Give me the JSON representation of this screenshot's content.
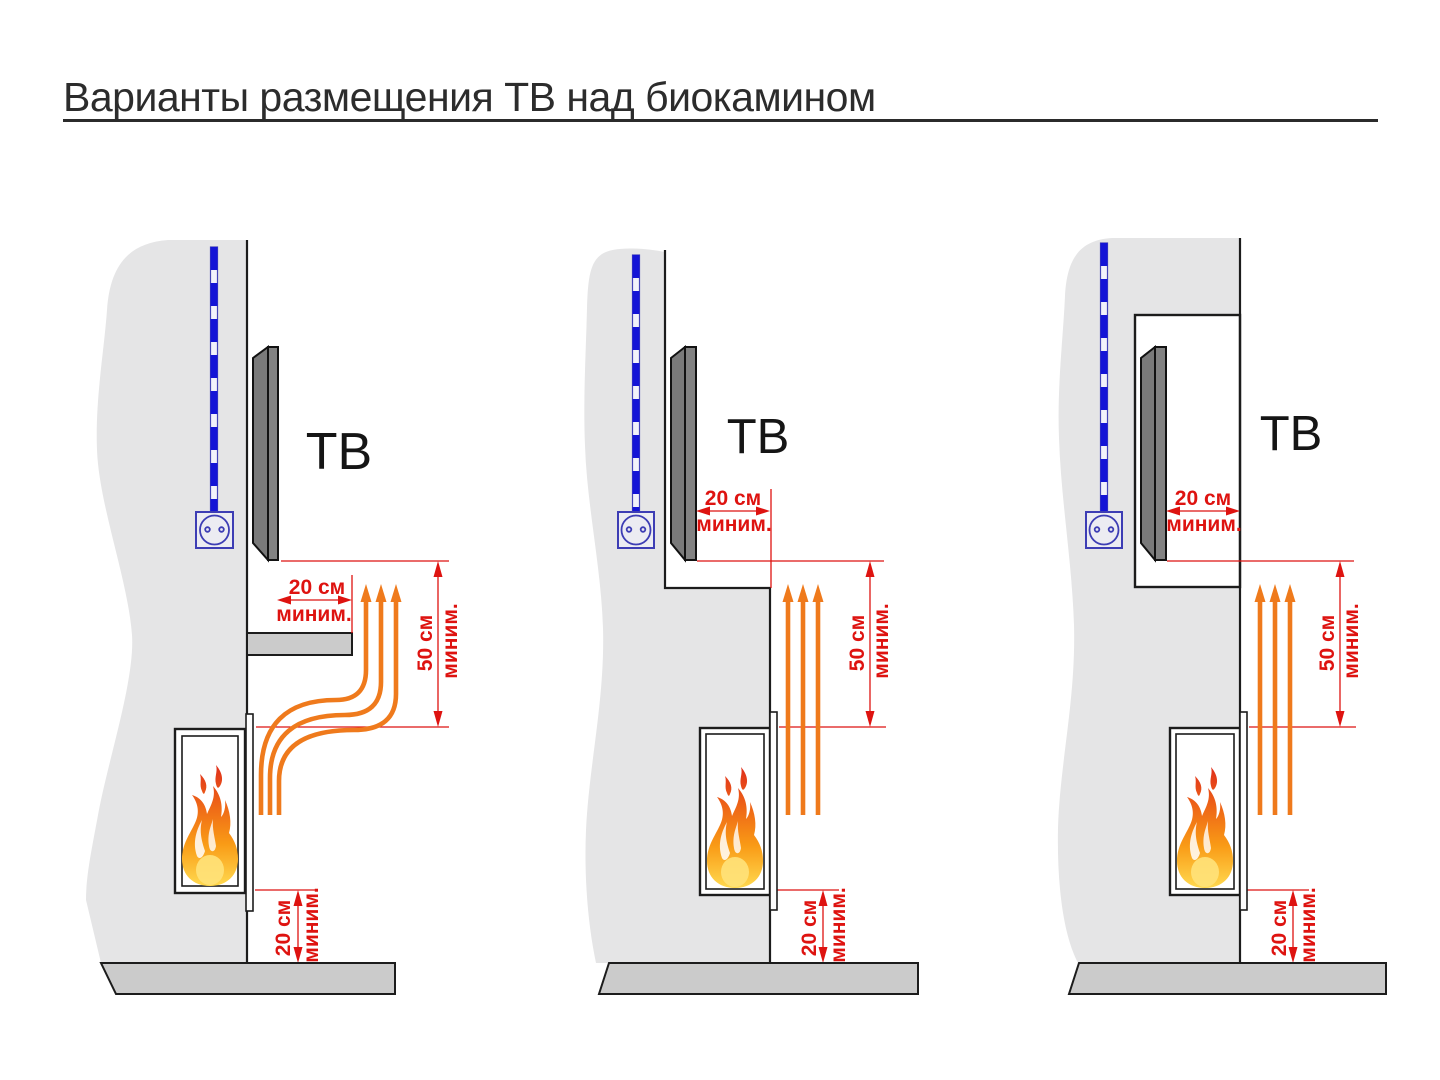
{
  "title": "Варианты размещения ТВ над биокамином",
  "colors": {
    "dimension_red": "#de1310",
    "heat_arrow_orange": "#ef7a1c",
    "cable_blue": "#1414d6",
    "wall_gray": "#e5e5e6",
    "floor_gray": "#cbcbcb",
    "tv_gray": "#828282",
    "outline_black": "#1c1c1c"
  },
  "diagrams": [
    {
      "id": "tv-above-shelf",
      "tv_label": "ТВ",
      "front_clearance": {
        "value": "20 см",
        "qualifier": "миним."
      },
      "vertical_clearance": {
        "value": "50 см",
        "qualifier": "миним."
      },
      "floor_clearance": {
        "value": "20 см",
        "qualifier": "миним."
      }
    },
    {
      "id": "tv-recessed-step",
      "tv_label": "ТВ",
      "front_clearance": {
        "value": "20 см",
        "qualifier": "миним."
      },
      "vertical_clearance": {
        "value": "50 см",
        "qualifier": "миним."
      },
      "floor_clearance": {
        "value": "20 см",
        "qualifier": "миним."
      }
    },
    {
      "id": "tv-in-niche",
      "tv_label": "ТВ",
      "front_clearance": {
        "value": "20 см",
        "qualifier": "миним."
      },
      "vertical_clearance": {
        "value": "50 см",
        "qualifier": "миним."
      },
      "floor_clearance": {
        "value": "20 см",
        "qualifier": "миним."
      }
    }
  ]
}
